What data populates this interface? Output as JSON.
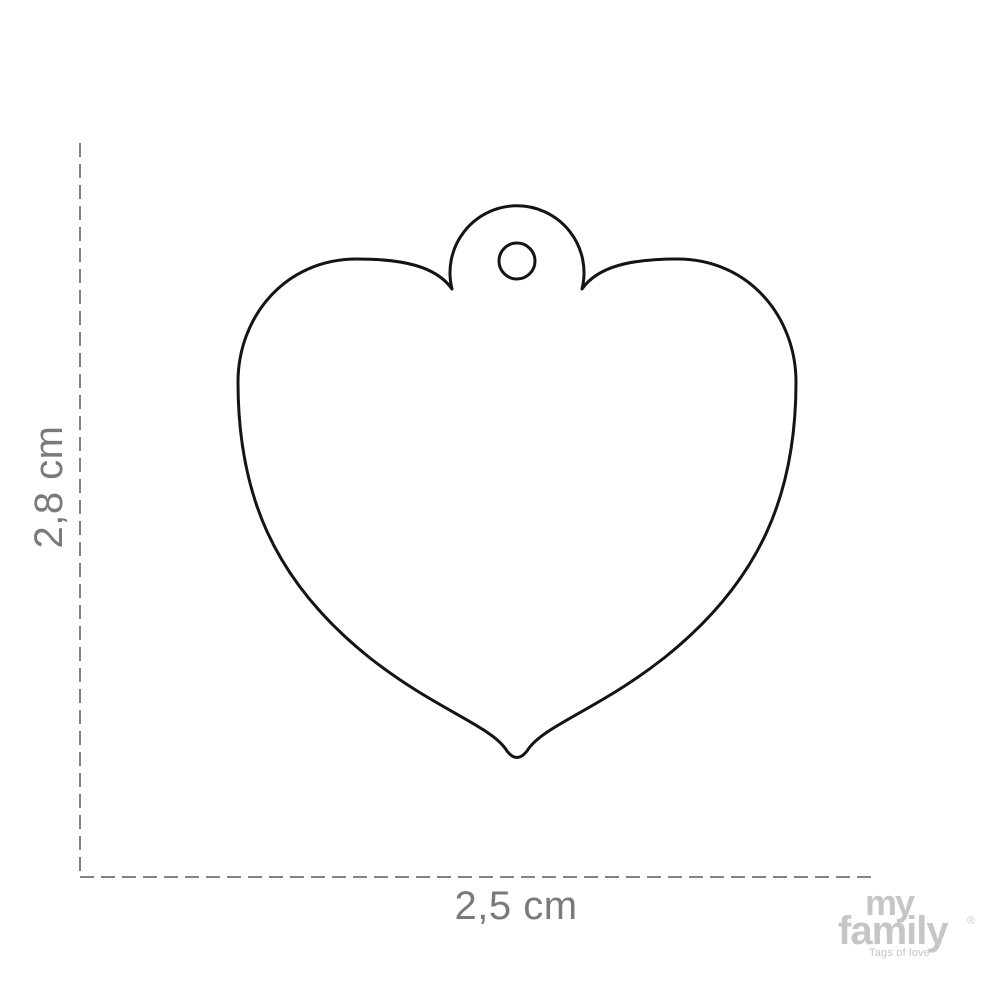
{
  "diagram": {
    "description": "Heart-shaped pet ID tag outline drawing with hanging hole and size dimensions",
    "height_label": "2,8 cm",
    "width_label": "2,5 cm"
  },
  "logo": {
    "word_top": "my",
    "word_bottom": "family",
    "registered_mark": "®",
    "tagline": "Tags of love"
  },
  "colors": {
    "background": "#ffffff",
    "outline": "#141414",
    "dimension_line": "#828282",
    "dimension_text": "#7a7a7a",
    "logo": "#c6c6c6"
  }
}
